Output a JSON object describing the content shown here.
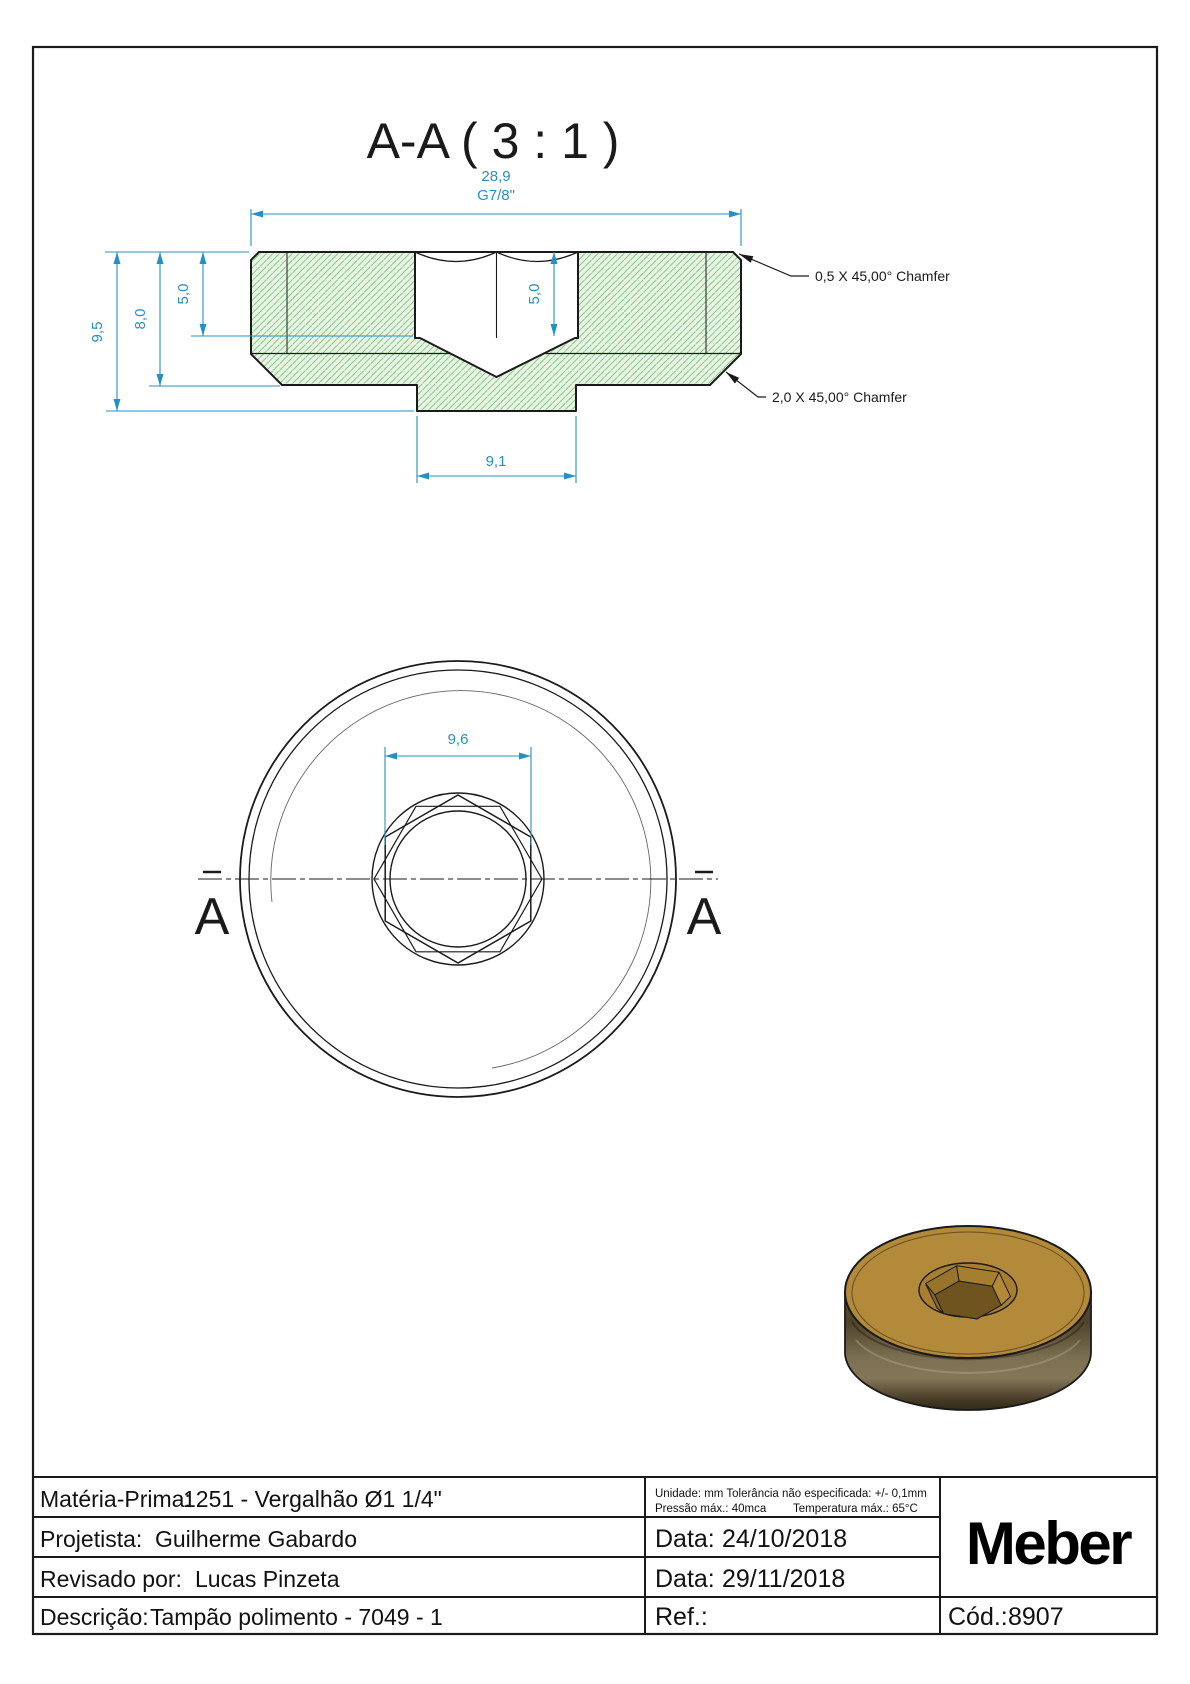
{
  "colors": {
    "line": "#1a1a1a",
    "dimension_blue": "#2590c6",
    "hatch_fill": "#e9f5e4",
    "hatch_line": "#8cc98c",
    "thin_line": "#666666",
    "brass_top": "#b3893a",
    "brass_ring": "#a87f31",
    "brass_wall_light": "#b28936",
    "brass_wall_far": "#a57e30",
    "brass_wall_dark": "#8a6826",
    "brass_wall_darker": "#7f5f23",
    "brass_wall_mid": "#97732c",
    "socket_floor": "#6f5420",
    "logo_black": "#000000"
  },
  "section_view": {
    "title": "A-A ( 3 : 1 )",
    "dim_width": "28,9",
    "dim_thread": "G7/8\"",
    "dim_total_height": "9,5",
    "dim_body_height": "8,0",
    "dim_socket_depth": "5,0",
    "dim_socket_depth_inner": "5,0",
    "dim_spigot_width": "9,1",
    "note_chamfer_top": "0,5 X 45,00° Chamfer",
    "note_chamfer_bottom": "2,0 X 45,00° Chamfer"
  },
  "front_view": {
    "dim_hex": "9,6",
    "label_a_left": "A",
    "label_a_right": "A"
  },
  "title_block": {
    "materia_prima_label": "Matéria-Prima:",
    "materia_prima_value": "1251 - Vergalhão Ø1 1/4\"",
    "projetista_label": "Projetista:",
    "projetista_value": "Guilherme Gabardo",
    "revisado_label": "Revisado por:",
    "revisado_value": "Lucas Pinzeta",
    "descricao_label": "Descrição:",
    "descricao_value": "Tampão polimento - 7049 - 1",
    "tolerance_line1": "Unidade: mm Tolerância não especificada: +/- 0,1mm",
    "pressure": "Pressão máx.: 40mca",
    "temperature": "Temperatura máx.: 65°C",
    "data1_label": "Data:",
    "data1_value": "24/10/2018",
    "data2_label": "Data:",
    "data2_value": "29/11/2018",
    "ref_label": "Ref.:",
    "cod_label": "Cód.:",
    "cod_value": "8907",
    "logo": "Meber"
  }
}
